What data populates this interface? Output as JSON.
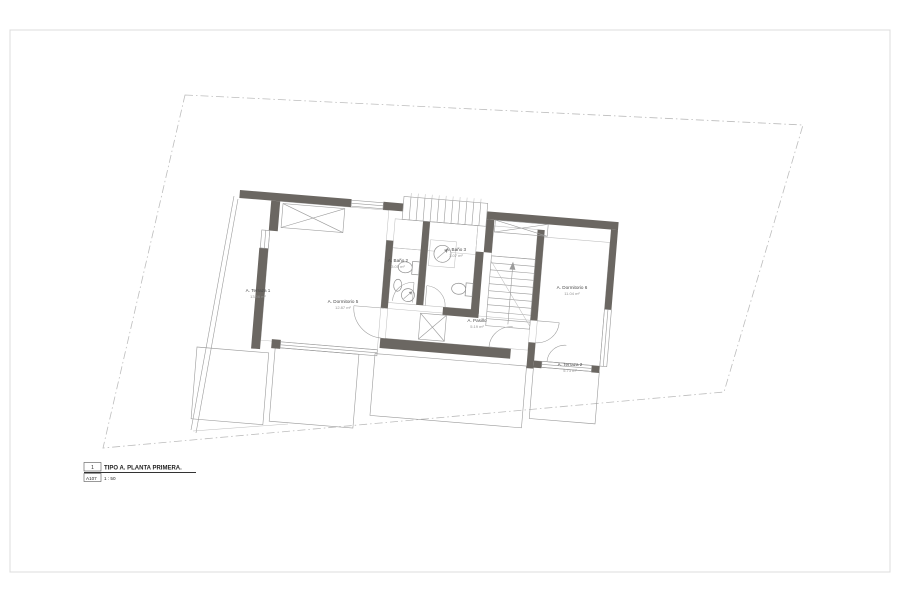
{
  "sheet": {
    "title_block": {
      "view_number": "1",
      "view_name": "TIPO A. PLANTA PRIMERA.",
      "sheet_ref": "A107",
      "scale": "1 : 50"
    }
  },
  "plan": {
    "rooms": [
      {
        "name": "A. Terraza 1",
        "area": "13.06 m²"
      },
      {
        "name": "A. Dormitorio 5",
        "area": "12.87 m²"
      },
      {
        "name": "A. Baño 2",
        "area": "3.05 m²"
      },
      {
        "name": "A. Baño 3",
        "area": "3.07 m²"
      },
      {
        "name": "A. Pasillo",
        "area": "5.19 m²"
      },
      {
        "name": "A. Dormitorio 6",
        "area": "11.04 m²"
      },
      {
        "name": "A. Terraza 2",
        "area": "5.73 m²"
      }
    ],
    "colors": {
      "wall": "#6b6762",
      "thin_line": "#9b9b9b",
      "plot_boundary": "#bdbdbd",
      "label_text": "#4a4a4a"
    }
  }
}
